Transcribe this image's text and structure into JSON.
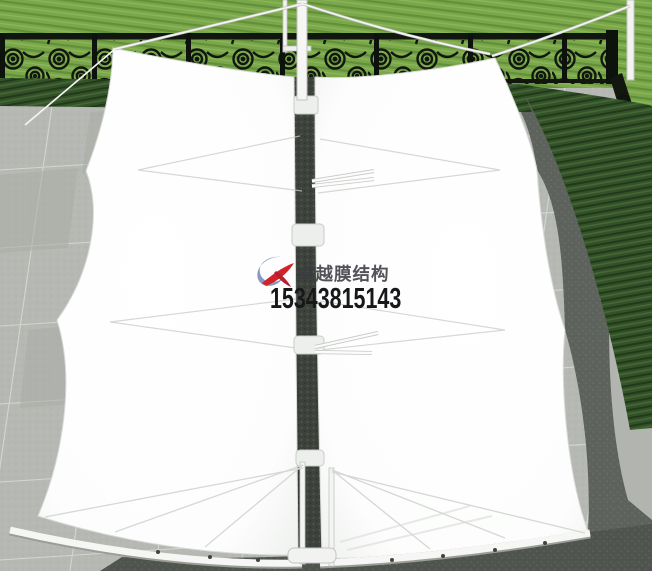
{
  "watermark": {
    "brand": "卓越膜结构",
    "phone": "15343815143",
    "logo_icon": "brand-swoosh-logo"
  },
  "scene": {
    "subject": "white-tensile-membrane-canopy-top-view",
    "elements": [
      "lawn",
      "wrought-iron-fence",
      "hedge",
      "paved-terrace",
      "membrane-left-panel",
      "membrane-right-panel",
      "center-mast",
      "corner-mast",
      "support-cables",
      "edge-beams",
      "canopy-shadow"
    ]
  },
  "colors": {
    "grass": "#79a749",
    "hedge": "#33522a",
    "fence": "#11160f",
    "pavement": "#b6b9b3",
    "pavement_dark": "#565b55",
    "membrane": "#ffffff",
    "logo_blue": "#8a97c0",
    "logo_red": "#d2232a",
    "text_dark": "#17181a"
  }
}
